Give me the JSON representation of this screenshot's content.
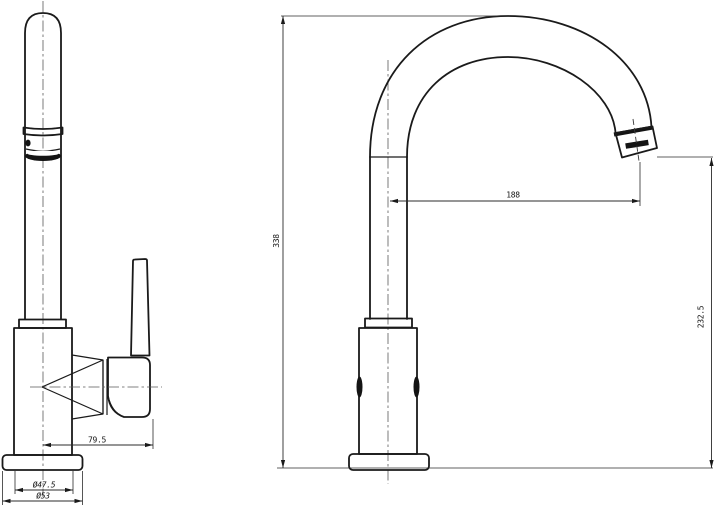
{
  "drawing": {
    "type": "technical-drawing",
    "subject": "single-lever gooseneck kitchen faucet, two orthographic views",
    "background_color": "#ffffff",
    "line_color": "#1a1a1a"
  },
  "views": {
    "front": {
      "label": "front-view"
    },
    "side": {
      "label": "side-view"
    }
  },
  "dimensions": {
    "front_handle_offset": "79.5",
    "front_body_diameter": "Ø47.5",
    "front_base_diameter": "Ø53",
    "side_spout_reach": "188",
    "side_total_height": "338",
    "side_outlet_height": "232.5"
  }
}
